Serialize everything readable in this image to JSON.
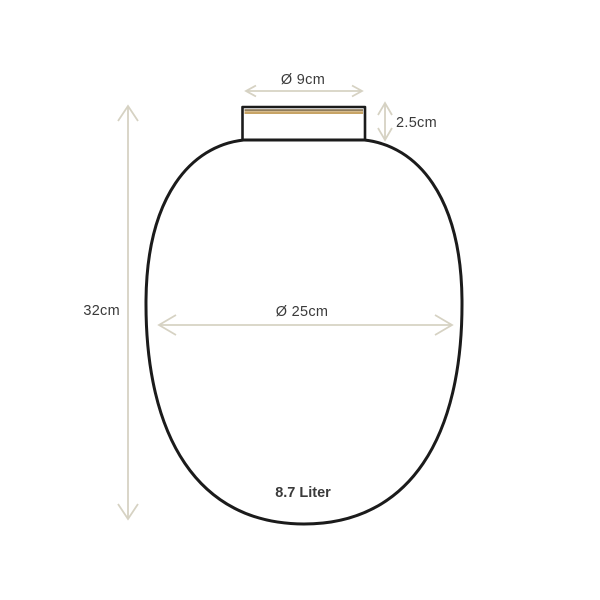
{
  "diagram": {
    "labels": {
      "top_diameter": "Ø 9cm",
      "neck_height": "2.5cm",
      "total_height": "32cm",
      "body_diameter": "Ø 25cm",
      "volume": "8.7 Liter"
    },
    "colors": {
      "background": "#ffffff",
      "outline": "#1b1b1b",
      "dimension": "#d6d2c3",
      "text": "#3a3a3a",
      "accent_gold": "#c7a466",
      "accent_shadow": "#6a5226"
    }
  }
}
